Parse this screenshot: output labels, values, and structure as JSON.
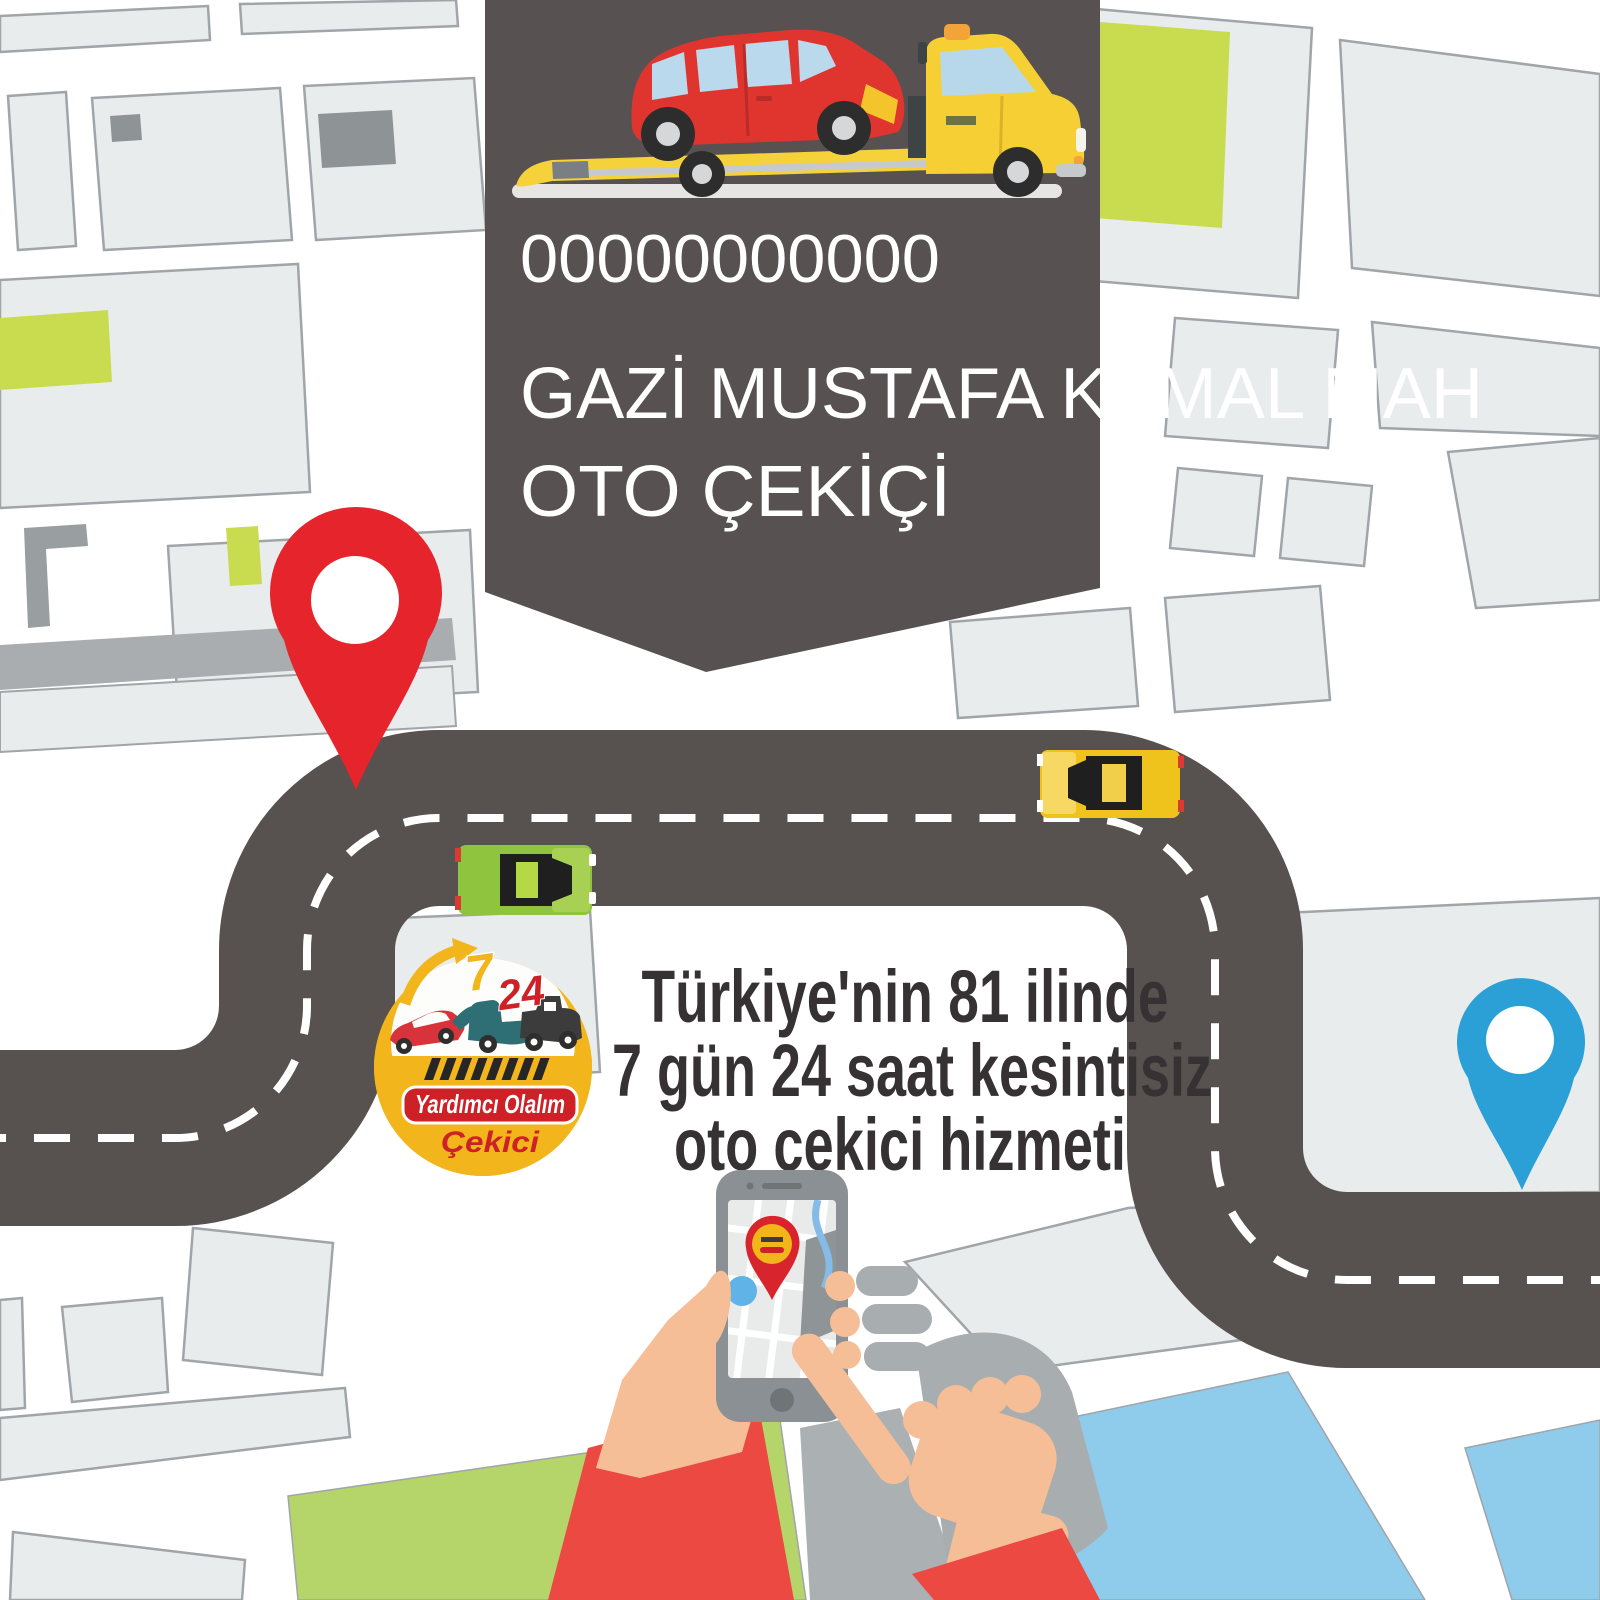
{
  "banner": {
    "phone": "00000000000",
    "line1": "GAZİ MUSTAFA KEMAL MAH",
    "line2": "OTO ÇEKİÇİ"
  },
  "headline": {
    "line1": "Türkiye'nin 81 ilinde",
    "line2": "7 gün 24 saat kesintisiz",
    "line3": "oto çekici hizmeti"
  },
  "logo": {
    "hours": "7",
    "day": "24",
    "ribbon": "Yardımcı Olalım",
    "caption": "Çekici"
  },
  "colors": {
    "banner_bg": "#575152",
    "road": "#575150",
    "map_block": "#E9ECED",
    "map_block_border": "#A0A5A9",
    "lime_block": "#C9DC4F",
    "park_green": "#B5D56B",
    "water_blue": "#8FCBEB",
    "pin_red": "#E5242C",
    "pin_blue": "#2AA0D6",
    "logo_yellow": "#F2B51C",
    "logo_red": "#CE2127",
    "headline_text": "#363233",
    "sleeve_red": "#EB4942",
    "skin": "#F6BE97",
    "taxi_yellow": "#EFC31C",
    "car_green": "#8FC43F"
  }
}
